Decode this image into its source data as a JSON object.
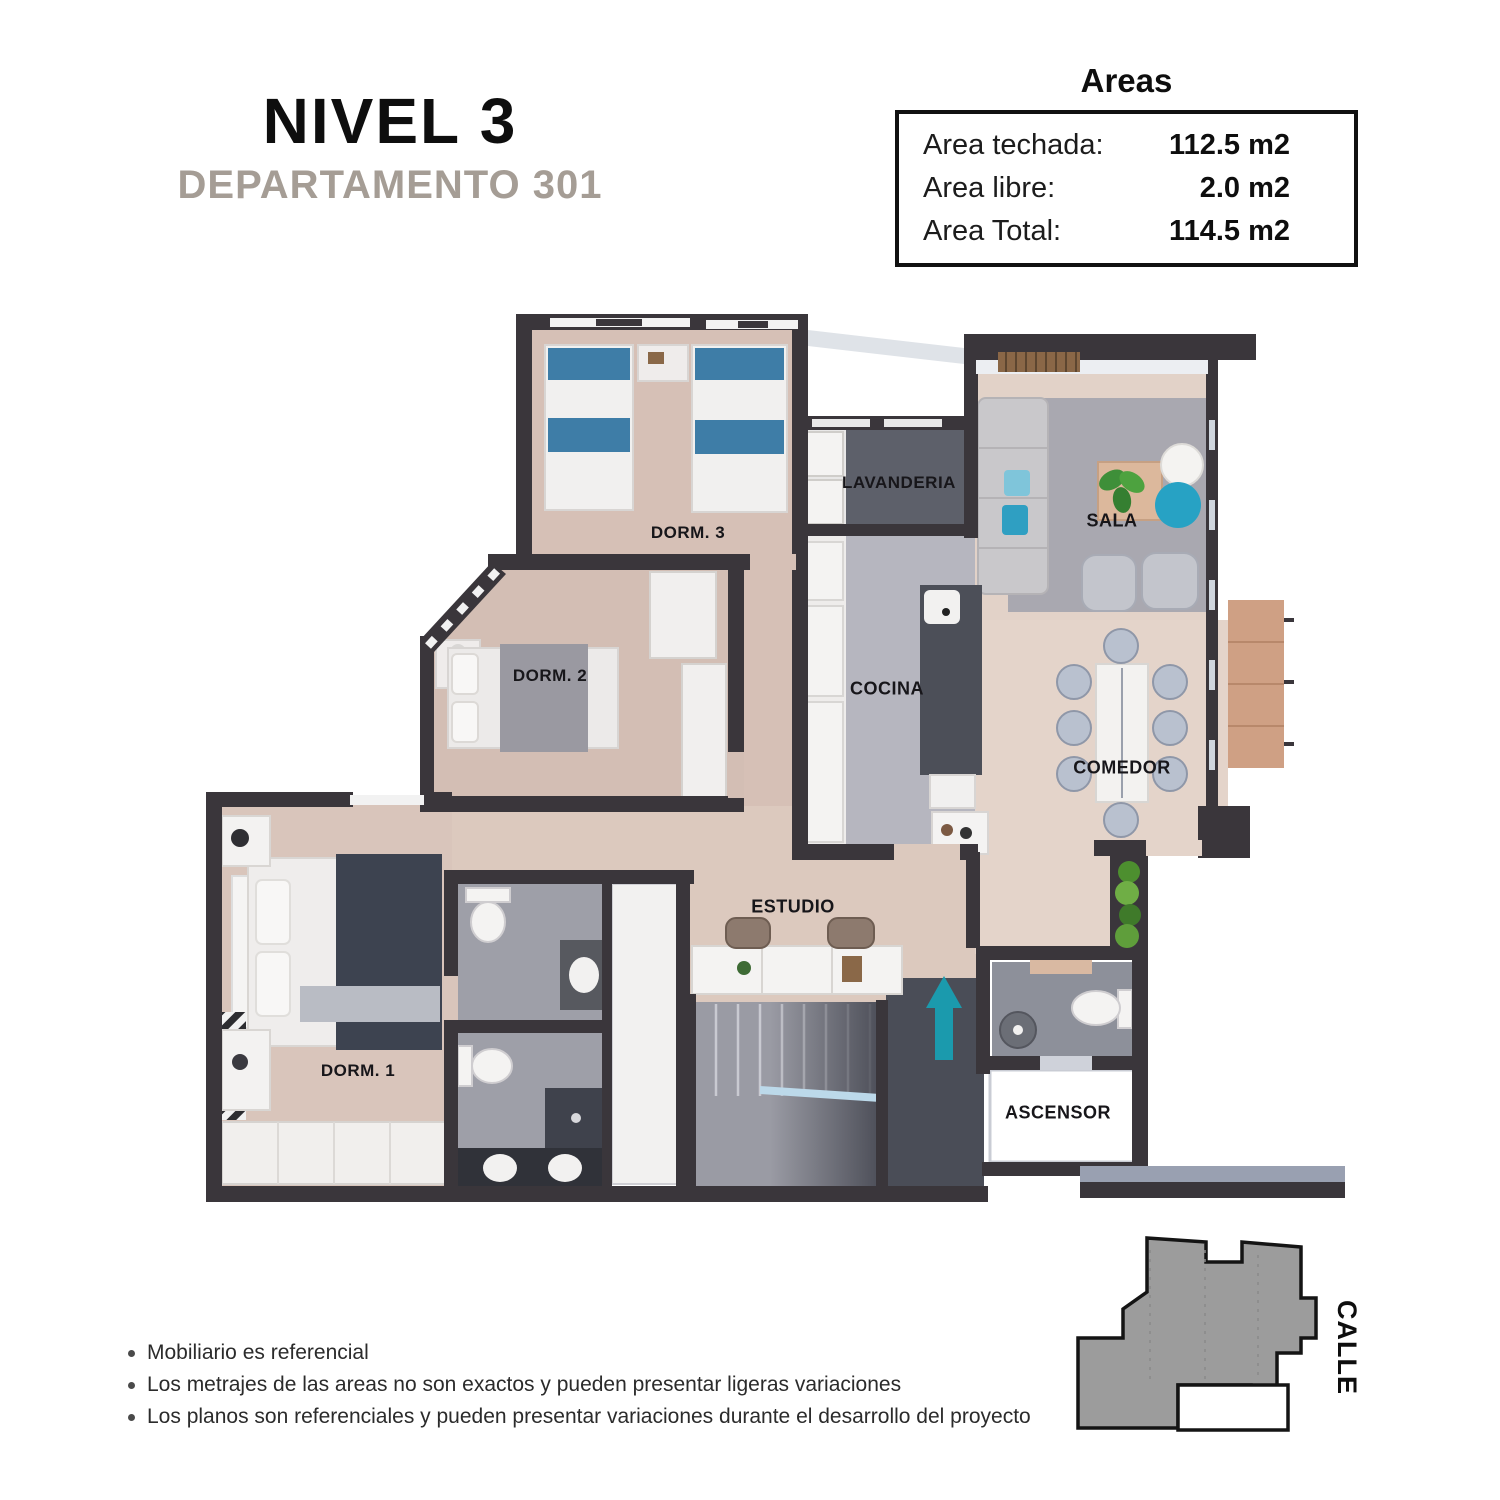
{
  "header": {
    "level_title": "NIVEL 3",
    "apartment_subtitle": "DEPARTAMENTO 301"
  },
  "areas_panel": {
    "title": "Areas",
    "rows": [
      {
        "label": "Area techada:",
        "value": "112.5 m2"
      },
      {
        "label": "Area libre:",
        "value": "2.0 m2"
      },
      {
        "label": "Area Total:",
        "value": "114.5 m2"
      }
    ]
  },
  "floor_plan": {
    "rooms": [
      {
        "id": "dorm-3",
        "label": "DORM. 3"
      },
      {
        "id": "lavanderia",
        "label": "LAVANDERIA"
      },
      {
        "id": "sala",
        "label": "SALA"
      },
      {
        "id": "dorm-2",
        "label": "DORM. 2"
      },
      {
        "id": "cocina",
        "label": "COCINA"
      },
      {
        "id": "comedor",
        "label": "COMEDOR"
      },
      {
        "id": "estudio",
        "label": "ESTUDIO"
      },
      {
        "id": "dorm-1",
        "label": "DORM. 1"
      },
      {
        "id": "ascensor",
        "label": "ASCENSOR"
      }
    ]
  },
  "key_plan": {
    "street_label": "CALLE"
  },
  "disclaimers": {
    "items": [
      "Mobiliario es referencial",
      "Los metrajes de las areas no son exactos y pueden presentar ligeras variaciones",
      "Los planos son referenciales y pueden presentar variaciones durante el desarrollo del proyecto"
    ]
  },
  "colors": {
    "wall": "#3a363b",
    "subtitle": "#a59d95",
    "accent_teal": "#1b9aad",
    "keyplan_gray": "#9c9c9c",
    "bed_blue": "#3e7da7"
  }
}
